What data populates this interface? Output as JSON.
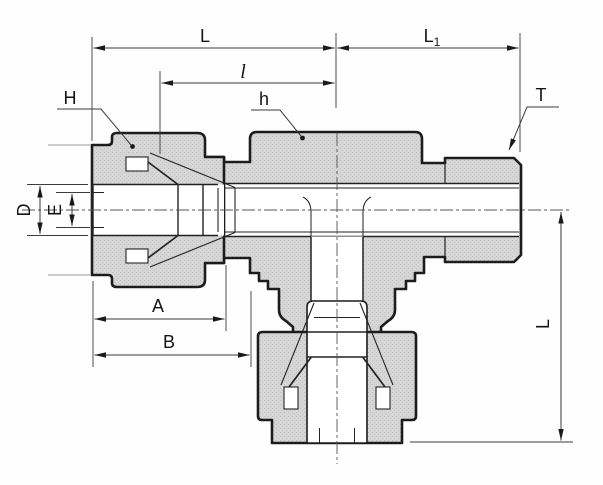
{
  "drawing": {
    "title": "tee-fitting-dimension-drawing",
    "dimensions": {
      "overall_length": "L",
      "right_end_length_base": "L",
      "right_end_length_sub": "1",
      "inner_length": "l",
      "nut_hex": "H",
      "body_hex": "h",
      "thread": "T",
      "tube_od": "D",
      "bore": "E",
      "nut_length": "A",
      "body_start_length": "B",
      "drop_length": "L"
    }
  }
}
